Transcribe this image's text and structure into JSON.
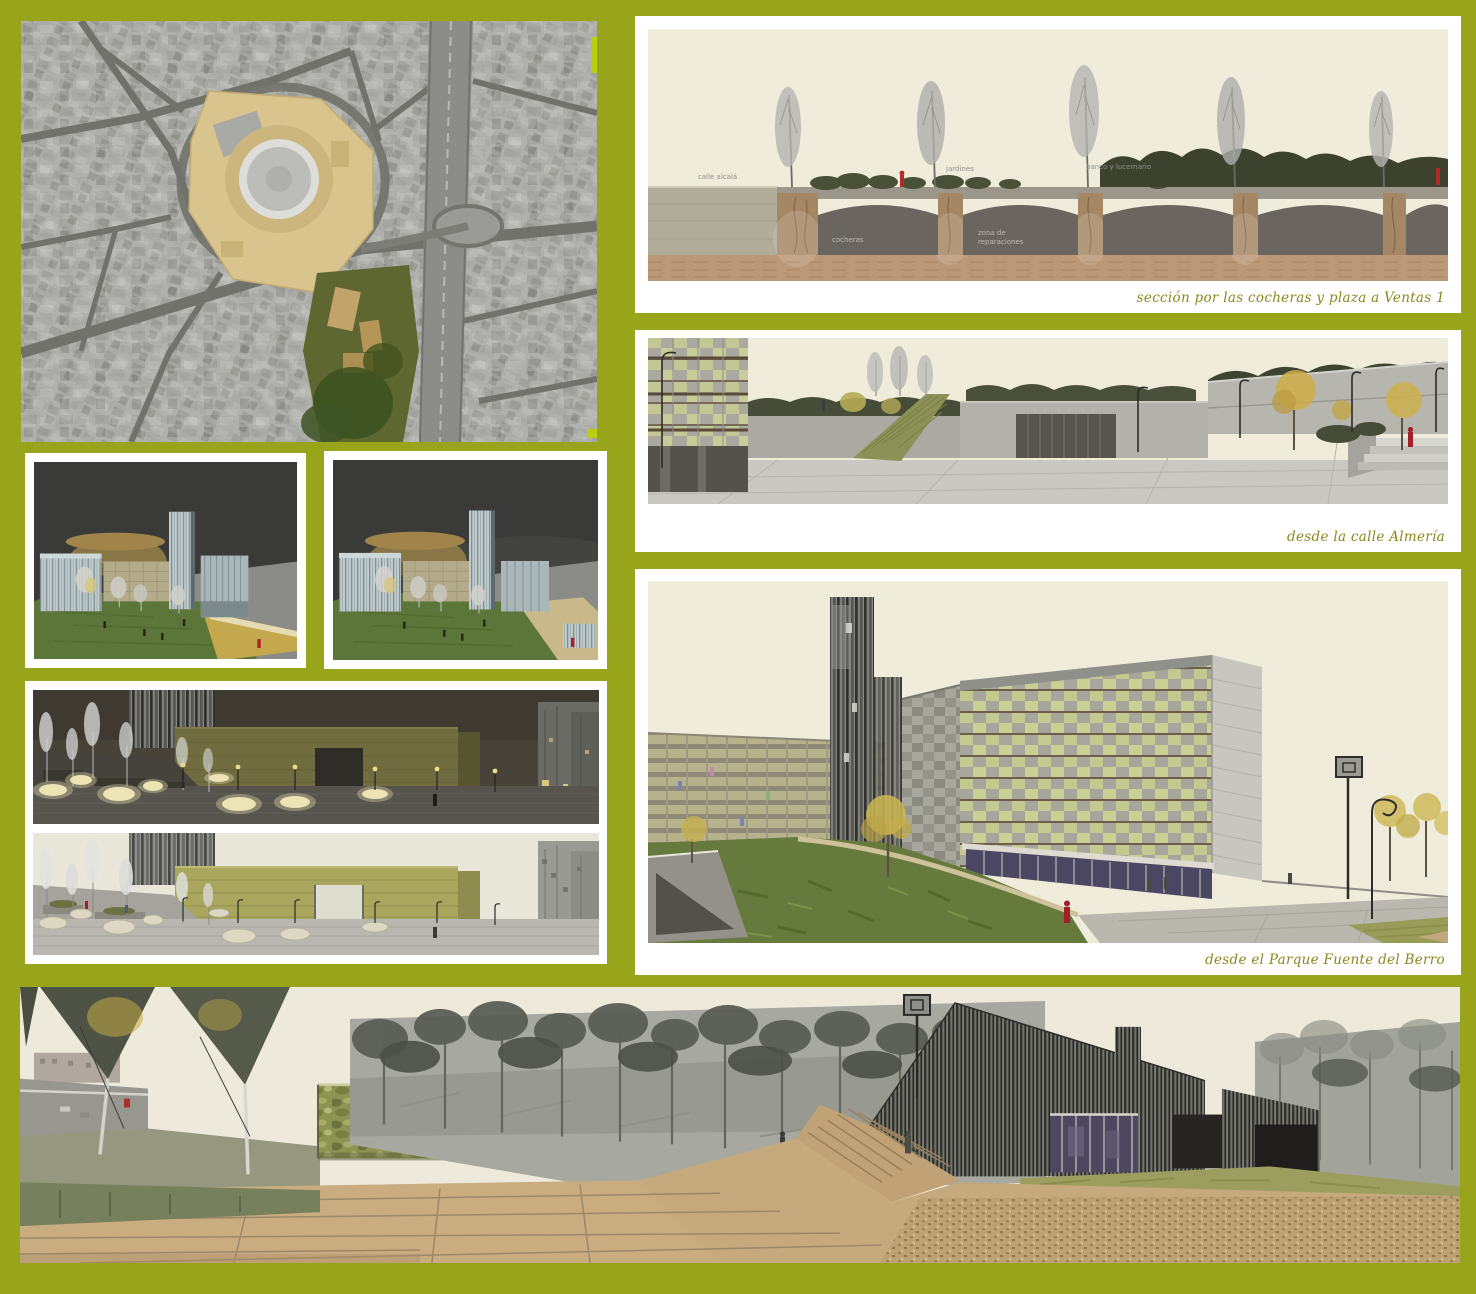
{
  "colors": {
    "board_background": "#98a51a",
    "panel_frame": "#ffffff",
    "caption_text": "#8e861d",
    "sky_cream": "#efecdb",
    "accent_red_figure": "#a62127",
    "facade_green": "#c4ca8f",
    "night_sky": "#474339"
  },
  "captions": {
    "section": "sección por las cocheras y plaza a Ventas 1",
    "almeria": "desde la calle Almería",
    "parque": "desde el Parque Fuente del Berro"
  },
  "section_labels": {
    "street": "calle alcalá",
    "gardens": "jardines",
    "bench_skylight": "banco y lucernario",
    "depot": "cocheras",
    "repairs_line1": "zona de",
    "repairs_line2": "reparaciones"
  }
}
